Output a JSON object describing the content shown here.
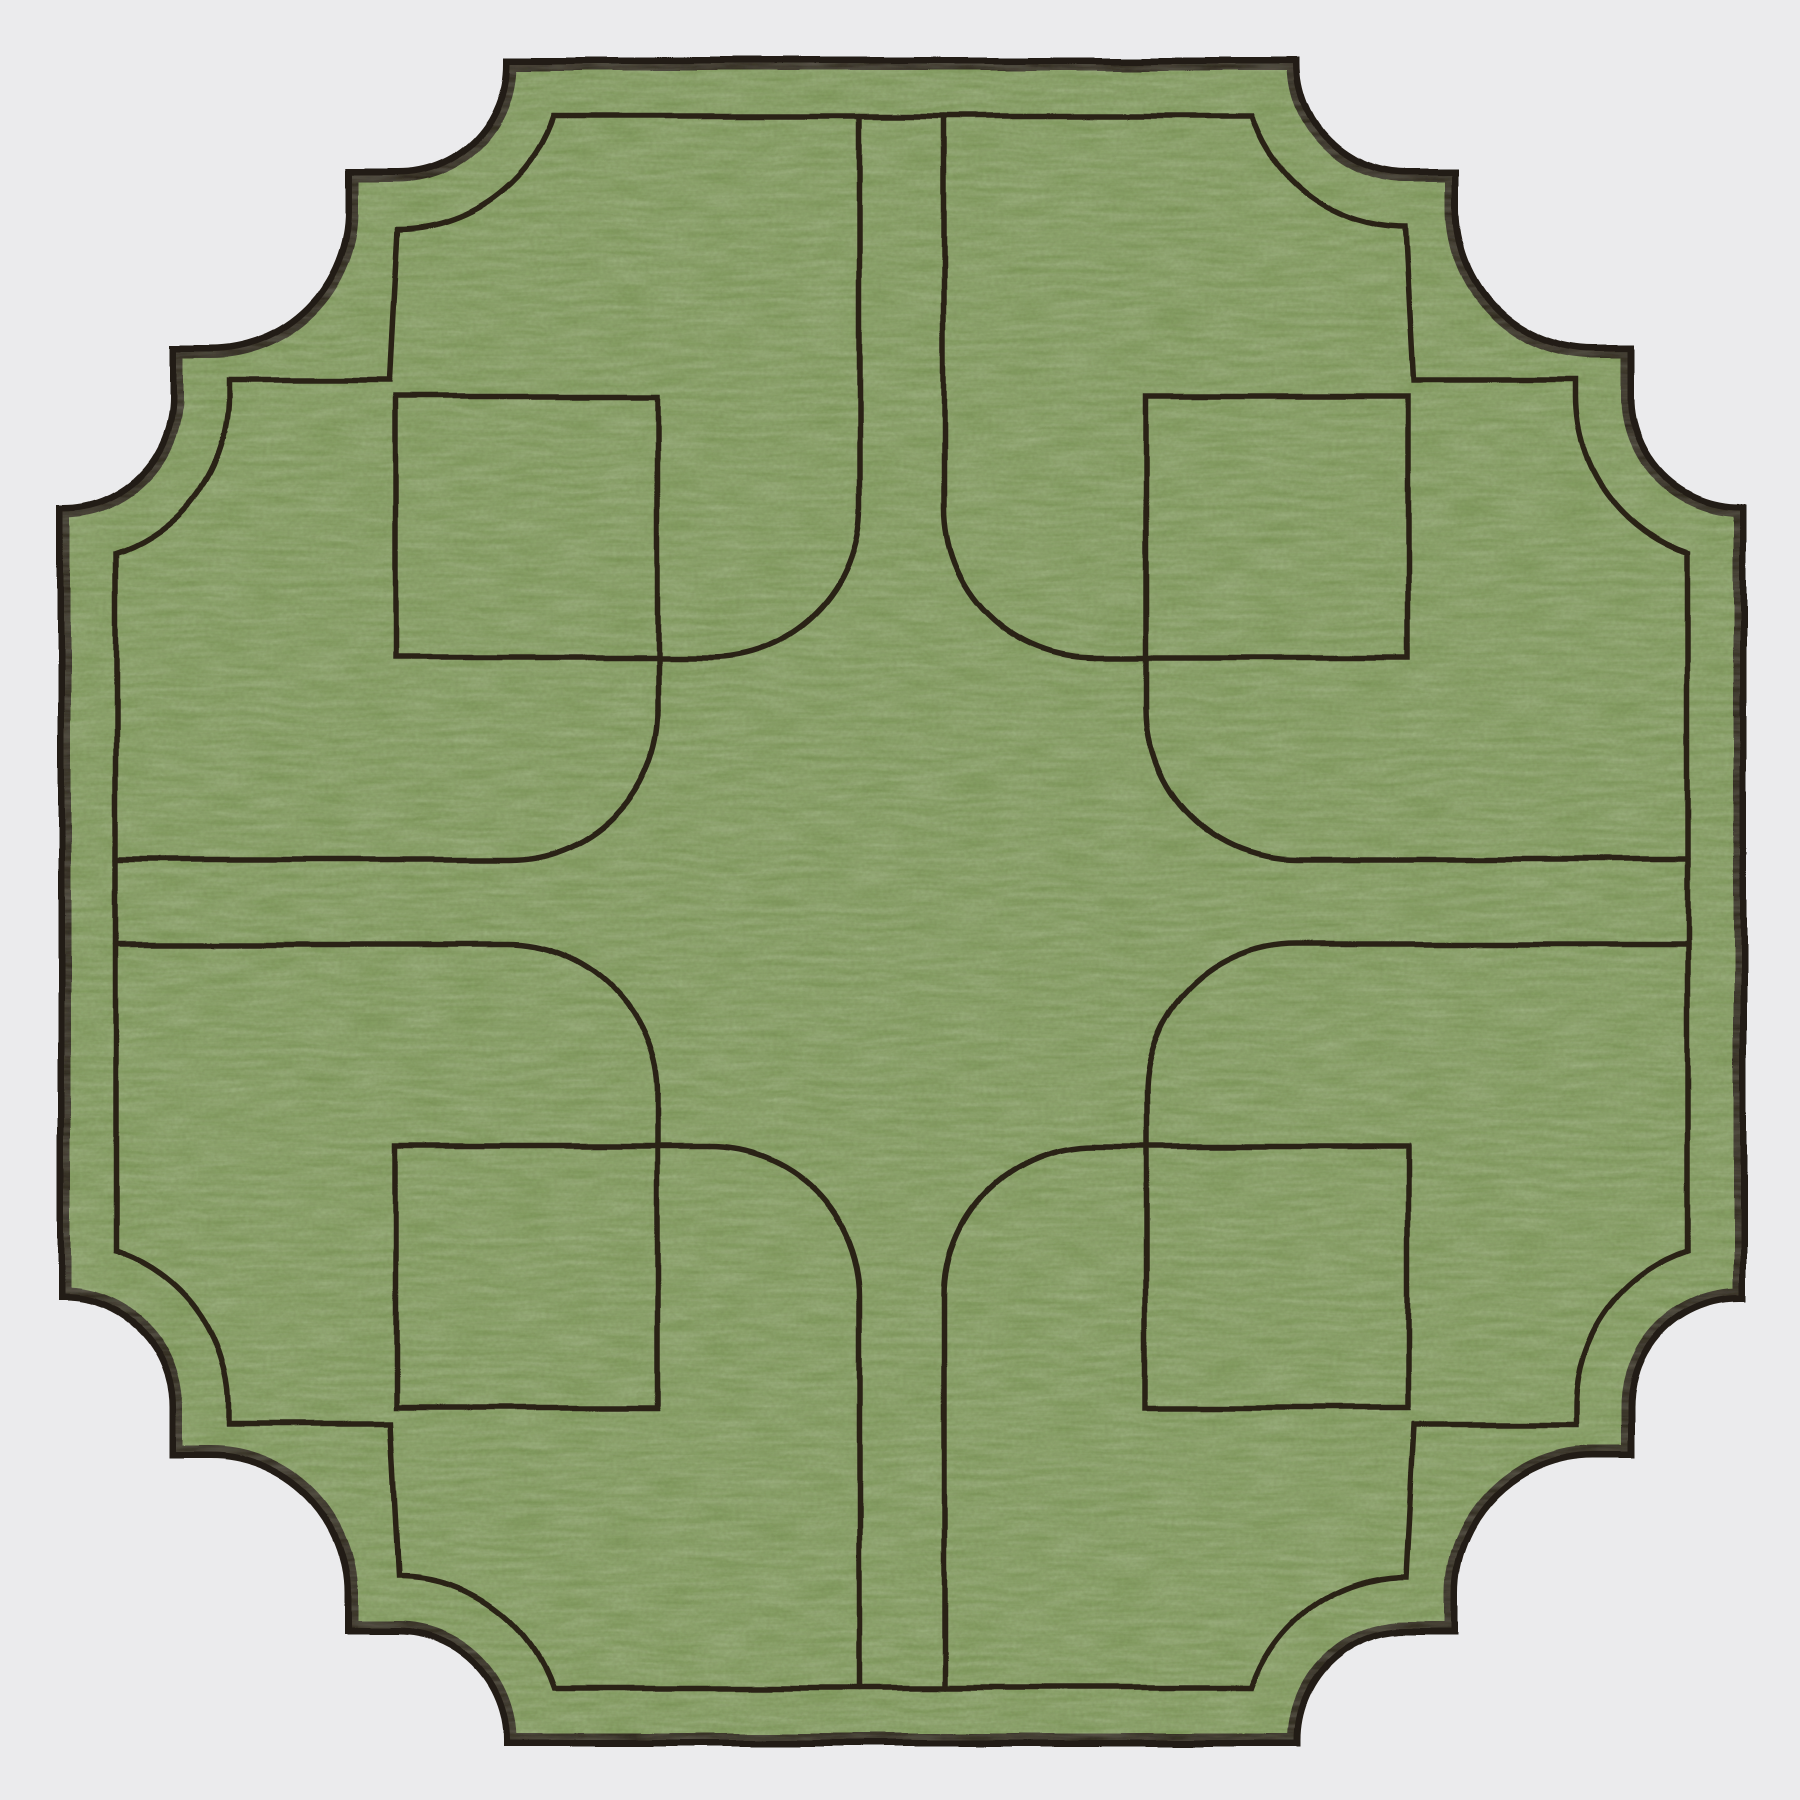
{
  "scene": {
    "description": "Product photograph of a square sage-green linen placemat with scalloped step-cut corners, dark brown edge trim and hand-embroidered parterre-garden pattern (central quatrefoil, four paths, four corner squares)",
    "background_color": "#ebebed"
  },
  "placemat": {
    "fabric_color": "#7f9b5c",
    "texture_highlight_color": "#ffffee",
    "texture_grain_color": "#171a0a",
    "trim_color": "#241d15",
    "stitch_color": "#2b2418",
    "trim_width": 13,
    "stitch_width": 5.5,
    "canvas_size": 1800,
    "center": 902,
    "outline": {
      "box_min": 64,
      "flat_end": 510,
      "scallop_radius": 112,
      "scallop_center_x": 398,
      "corner_arc_radius": 142,
      "corner_arc_center": 210,
      "step_outer": 352,
      "step_notch": 176,
      "inner_offset": 52,
      "inner_scallop_radius": 164,
      "inner_step_far": 390,
      "inner_step_near": 228,
      "inner_step_y": 380,
      "inner_flat": 116,
      "inner_flat_end": 553,
      "inner_arc_end": 553
    },
    "pattern": {
      "corridor_half_width": 42,
      "corridor_start": 116,
      "corridor_flare_start": 508,
      "flare_radius": 150,
      "square_min": 396,
      "square_max": 658,
      "whisker_tip": 710
    }
  }
}
